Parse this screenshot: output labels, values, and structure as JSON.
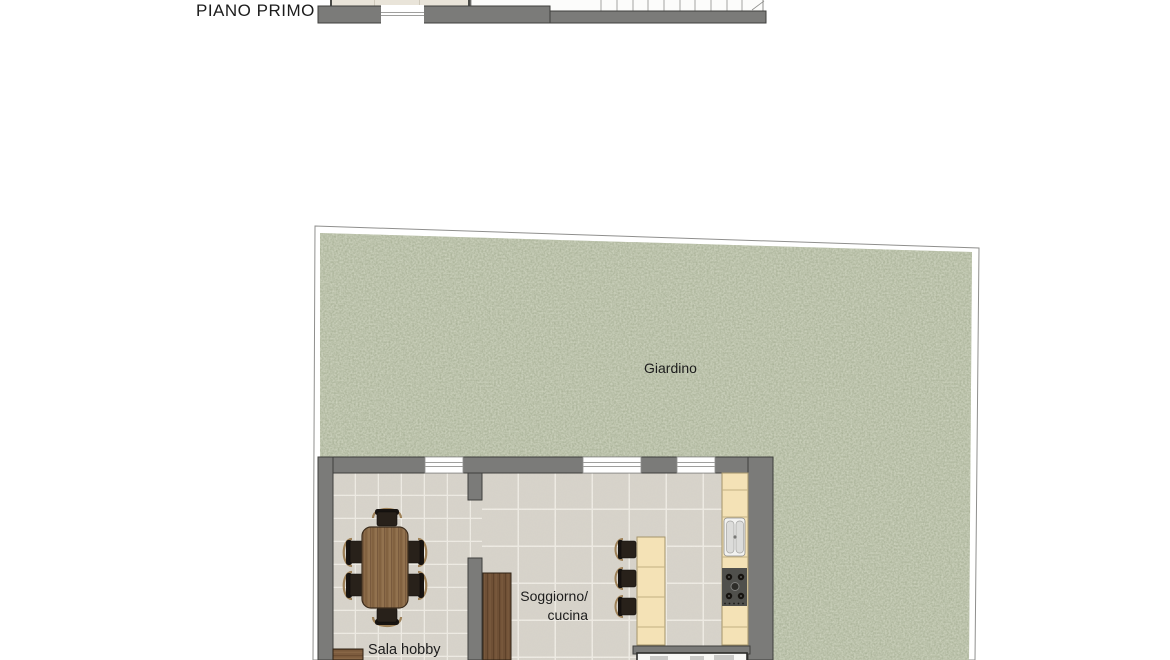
{
  "upper_plan": {
    "title": "PIANO PRIMO"
  },
  "garden": {
    "label": "Giardino"
  },
  "building": {
    "room_hobby": {
      "label": "Sala hobby"
    },
    "room_living": {
      "label_line1": "Soggiorno/",
      "label_line2": "cucina"
    }
  },
  "colors": {
    "wall": "#7b7b79",
    "wall_outline": "#3f3f3d",
    "grass": "#a3ac91",
    "grass_speckle": "#b8bea3",
    "tile_base": "#d6d2c9",
    "tile_grout": "#f0ede6",
    "wood_table": "#8a6a48",
    "wood_dark": "#6f5036",
    "counter": "#f4e2b6",
    "counter_line": "#c2b083",
    "hob_panel": "#50504c",
    "chair_seat": "#28211a",
    "chair_arm": "#9d8057",
    "window_fill": "#ffffff",
    "text": "#1c1c1c"
  }
}
